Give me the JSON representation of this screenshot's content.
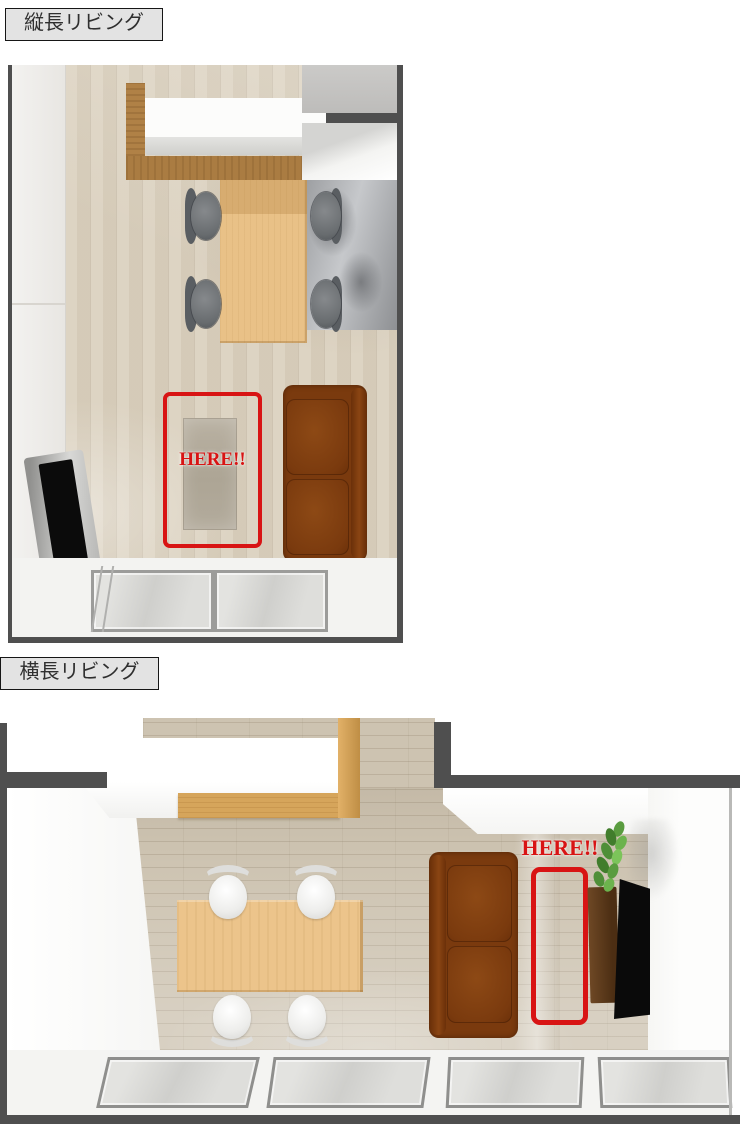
{
  "sections": [
    {
      "id": "vertical-living",
      "label": "縦長リビング",
      "here_text": "HERE!!"
    },
    {
      "id": "horizontal-living",
      "label": "横長リビング",
      "here_text": "HERE!!"
    }
  ],
  "colors": {
    "highlight_red": "#d81414",
    "wall_dark_gray": "#4f4f4f",
    "label_background": "#e3e3e3",
    "sofa_brown": "#7a3a0e",
    "floor_wood_vertical_room": "#dbd1bf",
    "floor_wood_horizontal_room": "#cdc3b1",
    "counter_wood": "#b08146",
    "table_wood": "#e9c187"
  }
}
